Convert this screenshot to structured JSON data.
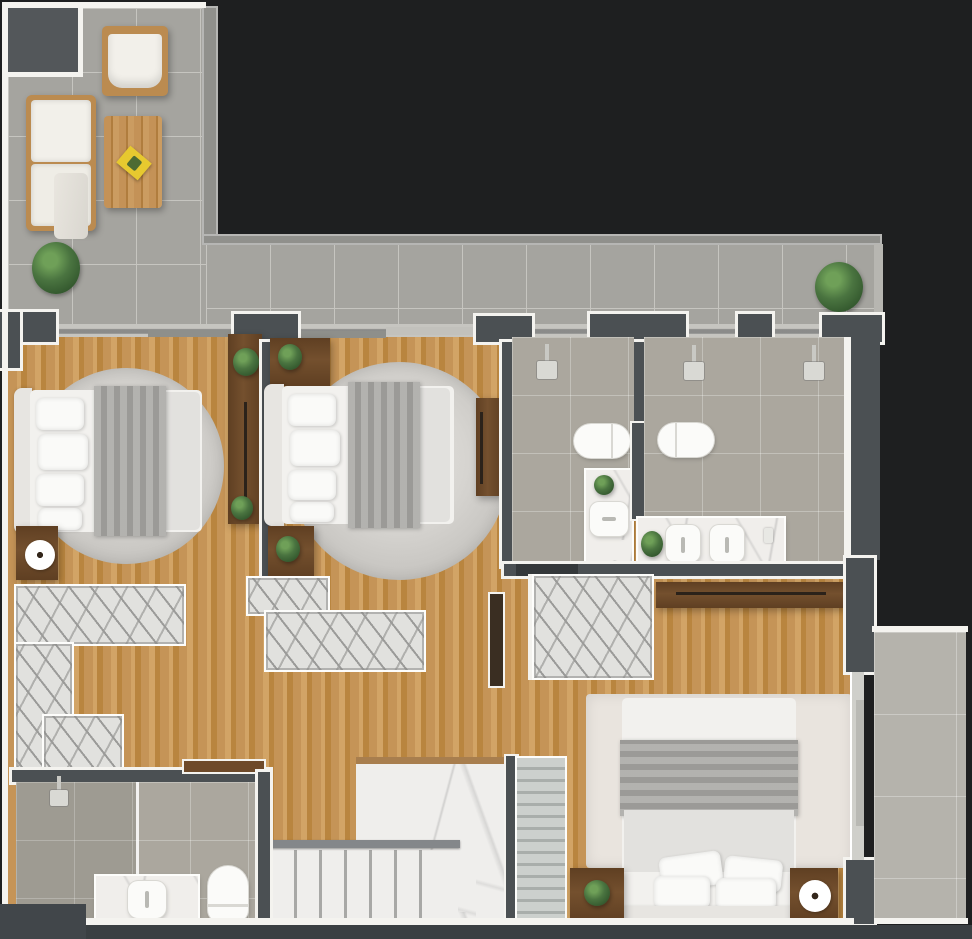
{
  "meta": {
    "kind": "3d-rendered apartment floor plan, top-down view",
    "text_visible_in_image": "none"
  },
  "colors": {
    "bg": "#1e1f20",
    "bottom-band": "#3a3f42",
    "block-grey": "#53575a",
    "wall-dark": "#4b5053",
    "wall-white": "#f4f3ef",
    "tile": "#a5a49f",
    "tile-line": "#c6c5c0",
    "bath-tile": "#aba79e",
    "balcony-tile": "#b5b3ac",
    "wood-a": "#c59457",
    "wood-b": "#b9853f",
    "wood-c": "#d2a466",
    "rug-light": "#d7d5d1",
    "rug-mid": "#c3c1bd",
    "rug-bedroom3": "#e9e4de",
    "marble": "#efeeec",
    "closet-bg": "#e1e1de",
    "closet-hatch": "#9b9b99",
    "linen": "#f2f1ee",
    "sheet": "#e2e1de",
    "blanket": "#a7a6a2",
    "pillow": "#fafaf8",
    "headboard": "#e7e5e1",
    "wardrobe": "#74502e",
    "wardrobe-dark": "#5f3f22",
    "handle": "#2b221a",
    "plant": "#4a7440",
    "plant-dark": "#2c4f28",
    "flower-center": "#33261b",
    "fixture": "#fbfbf9",
    "fixture-line": "#d9d8d3",
    "counter": "#f0eeeb",
    "sill": "#c6c5c0",
    "parapet": "#90908c",
    "tread-light": "#ccd0cd",
    "tread-dark": "#a9aeab",
    "rail": "#84878a",
    "accent-yellow": "#e7c92f",
    "door-brown": "#6e4a2a",
    "door-dark": "#3a2e22",
    "glass": "#cfcfca",
    "shower-grey": "#d9d9d4"
  },
  "rooms": [
    {
      "id": "terrace",
      "floor": "grey-tile",
      "furniture": [
        "loveseat-sofa",
        "armchair",
        "wood-coffee-table",
        "yellow-magazine",
        "potted-plant",
        "potted-plant"
      ]
    },
    {
      "id": "bedroom-1",
      "floor": "wood",
      "furniture": [
        "double-bed",
        "round-rug",
        "nightstand",
        "flower-decor",
        "tall-wardrobe",
        "plant",
        "plant"
      ]
    },
    {
      "id": "bedroom-2",
      "floor": "wood",
      "furniture": [
        "double-bed",
        "round-rug",
        "nightstand",
        "nightstand",
        "tall-wardrobe",
        "plant",
        "plant"
      ]
    },
    {
      "id": "bathroom-1",
      "floor": "grey-tile",
      "furniture": [
        "shower-head",
        "wall-hung-toilet",
        "vanity-counter",
        "sink",
        "plant"
      ]
    },
    {
      "id": "bathroom-2",
      "floor": "grey-tile",
      "furniture": [
        "shower-head",
        "shower-head",
        "wall-hung-toilet",
        "double-vanity-counter",
        "sink",
        "sink",
        "plant"
      ]
    },
    {
      "id": "walk-in-closet-1",
      "floor": "wood",
      "furniture": [
        "wardrobe-run",
        "wardrobe-run",
        "wardrobe-run"
      ]
    },
    {
      "id": "closet-2",
      "floor": "wood",
      "furniture": [
        "wardrobe-run",
        "wardrobe-run"
      ]
    },
    {
      "id": "closet-3",
      "floor": "wood",
      "furniture": [
        "wardrobe-run"
      ]
    },
    {
      "id": "hallway",
      "floor": "wood",
      "furniture": []
    },
    {
      "id": "stair-hall",
      "floor": "marble",
      "furniture": [
        "stair-flight-wide",
        "stair-flight-narrow",
        "glass-railing",
        "handrail"
      ]
    },
    {
      "id": "bathroom-3",
      "floor": "grey-tile",
      "furniture": [
        "shower-head",
        "glass-partition",
        "vanity-counter",
        "sink",
        "toilet"
      ]
    },
    {
      "id": "bedroom-3",
      "floor": "wood",
      "furniture": [
        "double-bed",
        "area-rug",
        "nightstand",
        "nightstand",
        "flower-decor",
        "dresser",
        "plant"
      ]
    },
    {
      "id": "balcony",
      "floor": "grey-tile",
      "furniture": []
    }
  ]
}
